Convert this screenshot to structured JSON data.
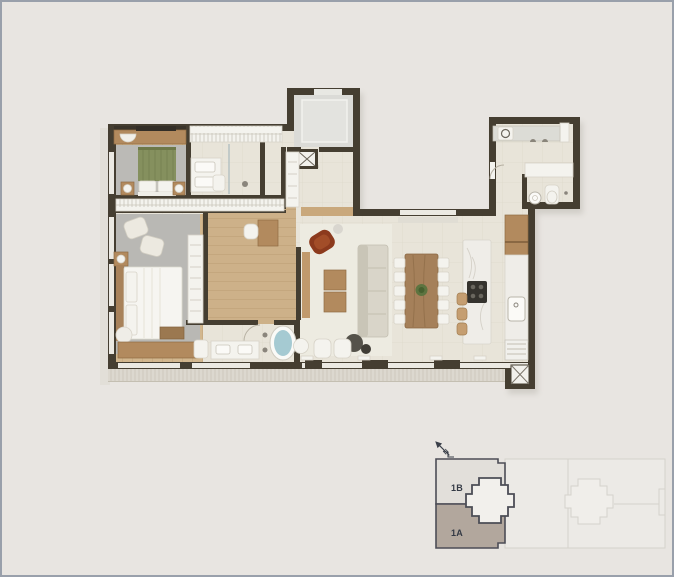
{
  "canvas": {
    "background": "#e8e5e1",
    "border_color": "#99a0ab"
  },
  "floorplan_colors": {
    "wall": "#453e31",
    "wood_floor": "#d2b78f",
    "hall_wood_floor": "#cdb189",
    "tile_floor": "#e8e4d9",
    "rug": "#b9b8b4",
    "white_fixture": "#f4f3ee",
    "wood_furniture": "#b28a5e",
    "bed_green": "#85905e",
    "bathtub_water": "#a5cad2",
    "accent_chair": "#8c3a1d",
    "marble": "#efede8",
    "deck": "#dcd8cf",
    "lobby_floor": "#dbdbd7"
  },
  "keyplan": {
    "north_label": "N",
    "units": [
      {
        "label": "1B",
        "fill": "#e2dfda",
        "selected": false
      },
      {
        "label": "1A",
        "fill": "#b2a79d",
        "selected": true
      }
    ],
    "outline_color": "#4c4d56",
    "faint_line_color": "#d5d2cc",
    "label_color": "#343a45",
    "core_fill": "#f2f0ec"
  }
}
